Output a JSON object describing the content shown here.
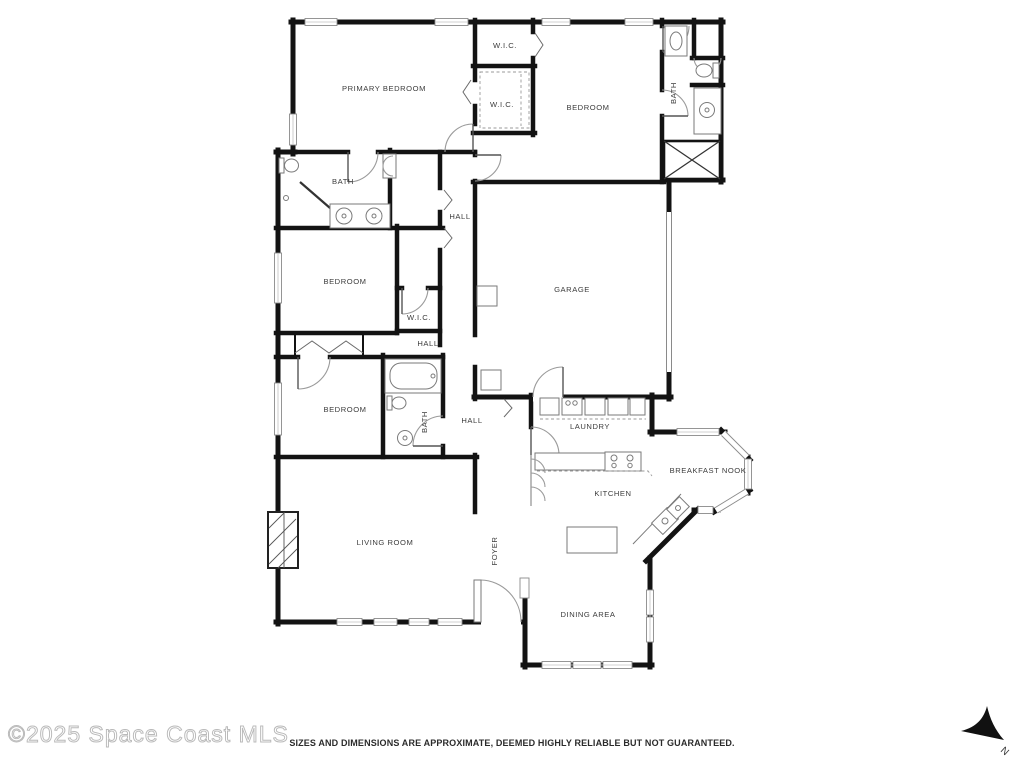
{
  "floor_plan": {
    "rooms": {
      "wic_top": "W.I.C.",
      "primary_bedroom": "PRIMARY BEDROOM",
      "wic_mid": "W.I.C.",
      "bedroom_top_right": "BEDROOM",
      "bath_right": "BATH",
      "bath_primary": "BATH",
      "hall_upper": "HALL",
      "bedroom_mid_left": "BEDROOM",
      "garage": "GARAGE",
      "wic_lower": "W.I.C.",
      "hall_mid": "HALL",
      "bedroom_lower_left": "BEDROOM",
      "bath_lower": "BATH",
      "hall_lower": "HALL",
      "laundry": "LAUNDRY",
      "breakfast_nook": "BREAKFAST NOOK",
      "kitchen": "KITCHEN",
      "living_room": "LIVING ROOM",
      "foyer": "FOYER",
      "dining_area": "DINING AREA"
    },
    "compass": {
      "north_label": "N"
    }
  },
  "footer": {
    "watermark": "©2025 Space Coast MLS",
    "disclaimer": "SIZES AND DIMENSIONS ARE APPROXIMATE, DEEMED HIGHLY RELIABLE BUT NOT GUARANTEED."
  },
  "colors": {
    "walls": "#131313",
    "labels": "#3c3c3c",
    "fixtures": "#7a7a7a",
    "watermark": "#b9b9b9",
    "disclaimer": "#2b2b2b"
  }
}
